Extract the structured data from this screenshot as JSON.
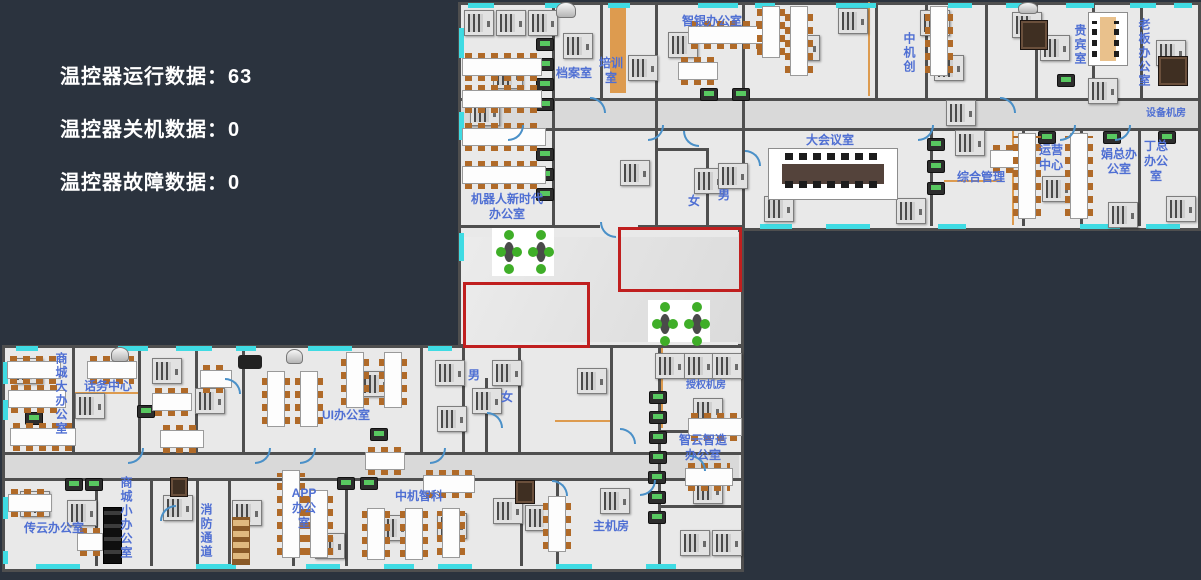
{
  "stats": {
    "running": {
      "label": "温控器运行数据：",
      "value": "63"
    },
    "shutdown": {
      "label": "温控器关机数据：",
      "value": "0"
    },
    "fault": {
      "label": "温控器故障数据：",
      "value": "0"
    }
  },
  "rooms": {
    "archive": "档案室",
    "training": "培训室",
    "zhiyin_office": "智银办公室",
    "zhongji_chuang": "中机创",
    "vip_room": "贵宾室",
    "boss_office": "老板办公室",
    "equipment_room": "设备机房",
    "conference_room": "大会议室",
    "general_management": "综合管理",
    "operations_center": "运营中心",
    "juan_office": "娟总办公室",
    "ding_office": "丁总办公室",
    "robot_office": "机器人新时代办公室",
    "female_upper": "女",
    "male_upper": "男",
    "mall_big_office": "商城大办公室",
    "call_center": "话务中心",
    "ui_office": "UI办公室",
    "male_lower": "男",
    "female_lower": "女",
    "auth_server_room": "授权机房",
    "zhiyun_office": "智云智造办公室",
    "chuanyun_office": "传云办公室",
    "mall_small_office": "商城小办公室",
    "fire_passage": "消防通道",
    "app_office": "APP办公室",
    "zhongji_zhike": "中机智科",
    "main_server_room": "主机房"
  },
  "colors": {
    "background": "#2b333e",
    "floor": "#e9e9e9",
    "wall": "#4f4f4f",
    "window_cyan": "#3fdbe3",
    "door_blue": "#4a90c8",
    "label_blue": "#4f6fd3",
    "alert_red": "#c01f1f",
    "device_screen_green": "#58c860",
    "partition_orange": "#dd9b4f"
  },
  "icons": {
    "ac_unit": "ac-unit-icon",
    "thermostat_panel": "thermostat-display-icon",
    "door": "door-arc-icon",
    "window": "window-icon"
  }
}
